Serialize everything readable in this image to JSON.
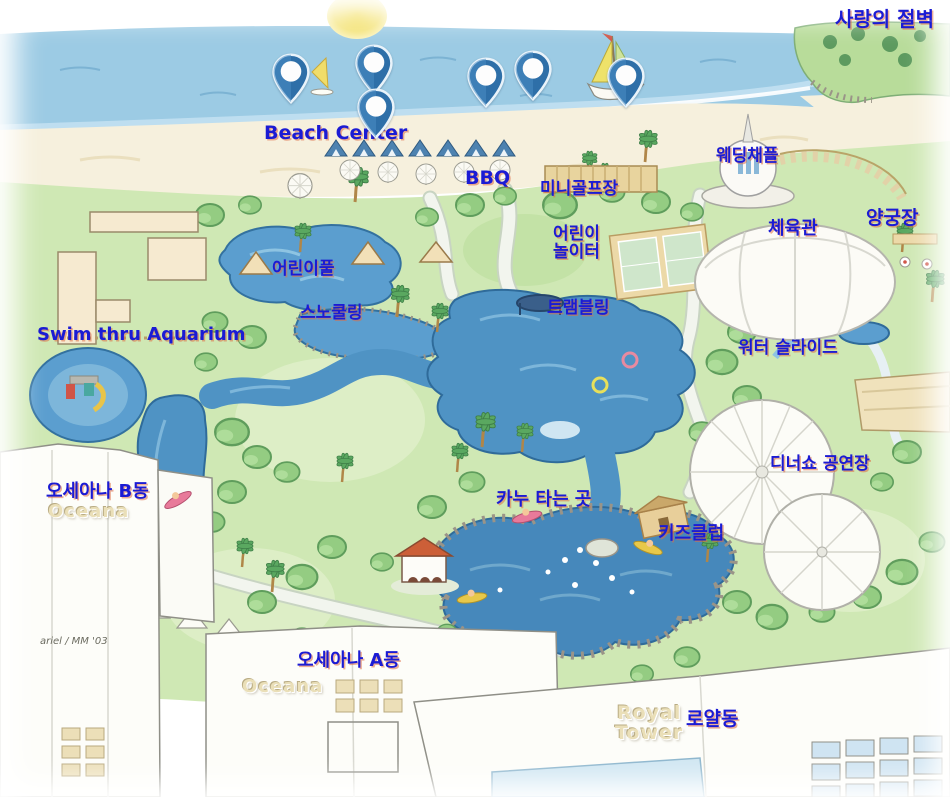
{
  "title": "Resort water-park illustrated map",
  "colors": {
    "label_blue": "#1b1bd4",
    "label_shadow": "#de6e46",
    "emboss_tan": "#eadfb8",
    "pin_blue": "#2e6fa8",
    "water_blue": "#4f93c4",
    "lagoon_blue": "#4688bb",
    "grass_green": "#cfe8b4",
    "sand": "#f6f0dd",
    "ocean": "#9ccbe4"
  },
  "map": {
    "labels": [
      {
        "id": "label-love-cliff",
        "text": "사랑의 절벽",
        "x": 835,
        "y": 9,
        "cls": "kr",
        "size": 20
      },
      {
        "id": "label-beach-center",
        "text": "Beach Center",
        "x": 264,
        "y": 124,
        "cls": "en",
        "size": 19
      },
      {
        "id": "label-bbq",
        "text": "BBQ",
        "x": 465,
        "y": 169,
        "cls": "en",
        "size": 19
      },
      {
        "id": "label-mini-golf",
        "text": "미니골프장",
        "x": 540,
        "y": 181,
        "cls": "kr",
        "size": 17
      },
      {
        "id": "label-wedding-chapel",
        "text": "웨딩채플",
        "x": 716,
        "y": 148,
        "cls": "kr",
        "size": 17
      },
      {
        "id": "label-gym",
        "text": "체육관",
        "x": 768,
        "y": 220,
        "cls": "kr",
        "size": 18
      },
      {
        "id": "label-archery",
        "text": "양궁장",
        "x": 866,
        "y": 209,
        "cls": "kr",
        "size": 19
      },
      {
        "id": "label-kids-playground",
        "text": "어린이\n놀이터",
        "x": 553,
        "y": 226,
        "cls": "kr center",
        "size": 17
      },
      {
        "id": "label-kids-pool",
        "text": "어린이풀",
        "x": 272,
        "y": 261,
        "cls": "kr",
        "size": 17
      },
      {
        "id": "label-snorkeling",
        "text": "스노쿨링",
        "x": 300,
        "y": 305,
        "cls": "kr",
        "size": 17
      },
      {
        "id": "label-trampoline",
        "text": "트램블링",
        "x": 547,
        "y": 300,
        "cls": "kr",
        "size": 17
      },
      {
        "id": "label-swim-aquarium",
        "text": "Swim thru Aquarium",
        "x": 37,
        "y": 326,
        "cls": "en",
        "size": 18
      },
      {
        "id": "label-water-slide",
        "text": "워터 슬라이드",
        "x": 738,
        "y": 340,
        "cls": "kr",
        "size": 17
      },
      {
        "id": "label-dinner-show",
        "text": "디너쇼 공연장",
        "x": 770,
        "y": 456,
        "cls": "kr",
        "size": 17
      },
      {
        "id": "label-oceana-b",
        "text": "오세아나 B동",
        "x": 46,
        "y": 483,
        "cls": "kr",
        "size": 18
      },
      {
        "id": "label-oceana-b-sign",
        "text": "Oceana",
        "x": 48,
        "y": 503,
        "cls": "emboss",
        "size": 18
      },
      {
        "id": "label-canoe",
        "text": "카누 타는 곳",
        "x": 496,
        "y": 491,
        "cls": "kr",
        "size": 18
      },
      {
        "id": "label-kids-club",
        "text": "키즈클럽",
        "x": 658,
        "y": 525,
        "cls": "kr",
        "size": 18
      },
      {
        "id": "label-signature",
        "text": "ariel / MM '03",
        "x": 40,
        "y": 637,
        "cls": "sig",
        "size": 10
      },
      {
        "id": "label-oceana-a",
        "text": "오세아나 A동",
        "x": 297,
        "y": 652,
        "cls": "kr",
        "size": 18
      },
      {
        "id": "label-oceana-a-sign",
        "text": "Oceana",
        "x": 242,
        "y": 678,
        "cls": "emboss",
        "size": 18
      },
      {
        "id": "label-royal-tower-sign",
        "text": "Royal\nTower",
        "x": 615,
        "y": 704,
        "cls": "emboss center",
        "size": 19
      },
      {
        "id": "label-royal",
        "text": "로얄동",
        "x": 686,
        "y": 710,
        "cls": "kr",
        "size": 19
      }
    ],
    "pins": [
      {
        "x": 291,
        "y": 73
      },
      {
        "x": 374,
        "y": 64
      },
      {
        "x": 376,
        "y": 108
      },
      {
        "x": 486,
        "y": 77
      },
      {
        "x": 533,
        "y": 70
      },
      {
        "x": 626,
        "y": 77
      }
    ]
  }
}
